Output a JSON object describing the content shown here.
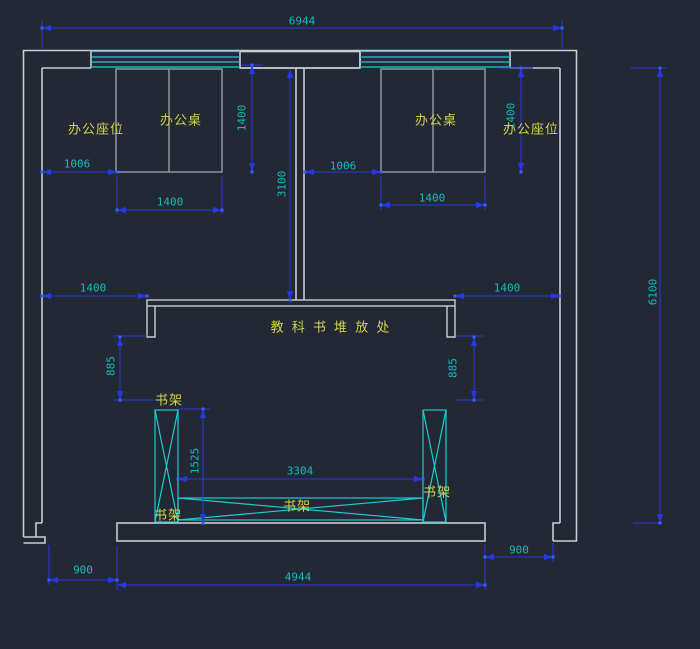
{
  "app": {
    "type": "cad-floor-plan-view"
  },
  "colors": {
    "background": "#222934",
    "wall": "#c9cdd2",
    "furniture": "#959da5",
    "window_shelf_cyan": "#17ced2",
    "dimension_line": "#2737e3",
    "dimension_text": "#14b9bd",
    "label_text": "#d2d348",
    "grip_point": "#3f5bff"
  },
  "labels": {
    "seat_left": "办公座位",
    "desk_left": "办公桌",
    "desk_right": "办公桌",
    "seat_right": "办公座位",
    "textbook_area": "教 科 书 堆 放 处",
    "shelf_top_left": "书架",
    "shelf_bottom_left": "书架",
    "shelf_middle": "书架",
    "shelf_right": "书架"
  },
  "dimensions": {
    "total_width": "6944",
    "total_height": "6100",
    "left_room_depth": "1400",
    "right_room_depth": "1400",
    "middle_corridor": "3100",
    "left_seat_width": "1006",
    "left_desk_width": "1400",
    "right_seat_width": "1006",
    "right_desk_width": "1400",
    "wall_to_counter_left": "1400",
    "counter_to_wall_right": "1400",
    "left_clearance": "885",
    "right_clearance": "885",
    "shelf_height": "1525",
    "shelf_span": "3304",
    "left_door": "900",
    "right_door": "900",
    "bottom_opening": "4944"
  }
}
